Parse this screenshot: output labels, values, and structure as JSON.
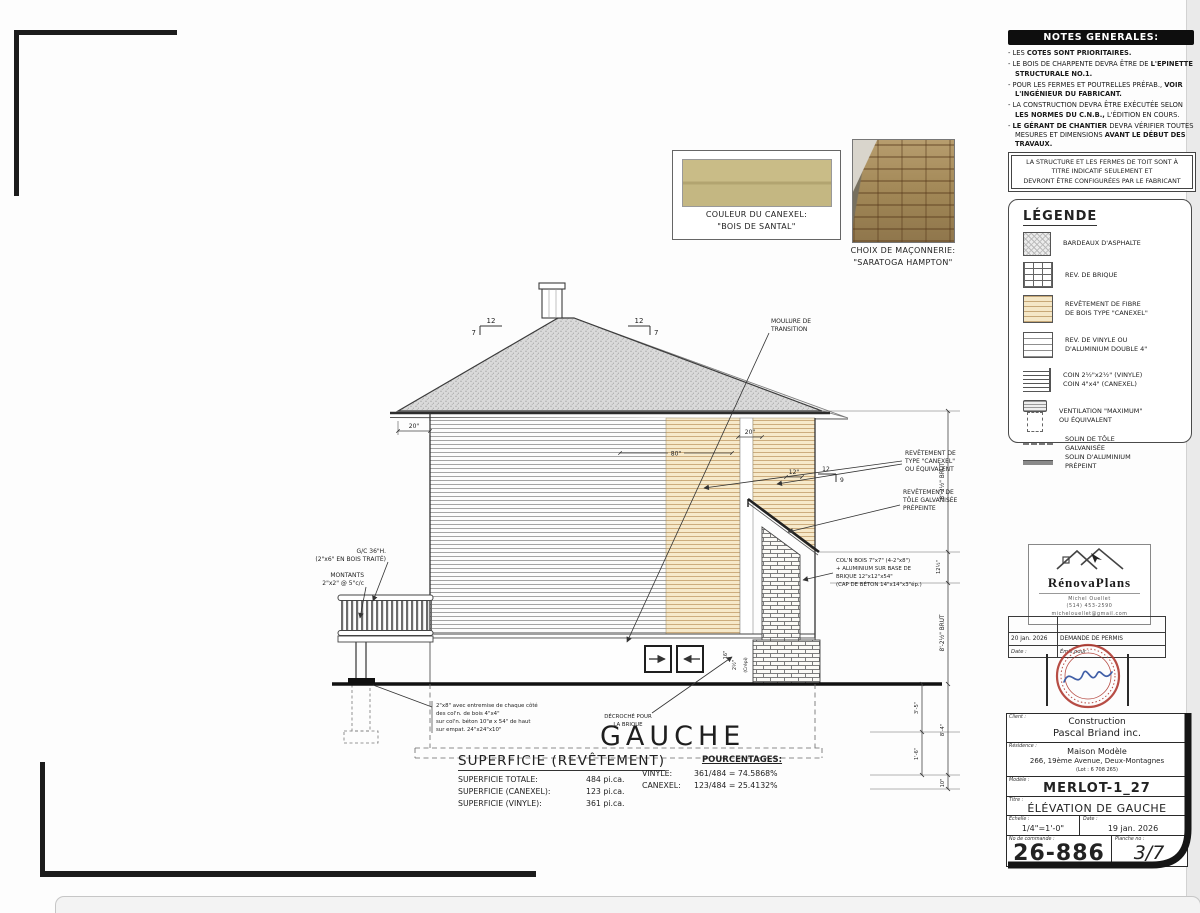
{
  "notes": {
    "header": "NOTES GENERALES:",
    "items": [
      [
        {
          "t": "LES ",
          "b": false
        },
        {
          "t": "COTES SONT PRIORITAIRES.",
          "b": true
        }
      ],
      [
        {
          "t": "LE BOIS DE CHARPENTE DEVRA ÊTRE DE ",
          "b": false
        },
        {
          "t": "L'EPINETTE STRUCTURALE NO.1.",
          "b": true
        }
      ],
      [
        {
          "t": "POUR LES FERMES ET POUTRELLES PRÉFAB., ",
          "b": false
        },
        {
          "t": "VOIR L'INGÉNIEUR DU FABRICANT.",
          "b": true
        }
      ],
      [
        {
          "t": "LA CONSTRUCTION DEVRA ÊTRE EXÉCUTÉE SELON ",
          "b": false
        },
        {
          "t": "LES NORMES DU C.N.B.,",
          "b": true
        },
        {
          "t": " L'ÉDITION EN COURS.",
          "b": false
        }
      ],
      [
        {
          "t": "LE GÉRANT DE CHANTIER ",
          "b": true
        },
        {
          "t": "DEVRA VÉRIFIER TOUTES MESURES ET DIMENSIONS ",
          "b": false
        },
        {
          "t": "AVANT LE DÉBUT DES TRAVAUX.",
          "b": true
        }
      ],
      [
        {
          "t": "AVERTIR",
          "b": true
        },
        {
          "t": " DE TOUTES ERREURS OU OMISSIONS ",
          "b": false
        },
        {
          "t": "AVANT LE DÉBUT DES TRAVAUX.",
          "b": true
        }
      ]
    ],
    "indicative": [
      "LA STRUCTURE ET LES FERMES DE TOIT SONT À",
      "TITRE INDICATIF SEULEMENT ET",
      "DEVRONT ÊTRE CONFIGURÉES PAR LE FABRICANT"
    ]
  },
  "legend": {
    "title": "LÉGENDE",
    "items": [
      {
        "type": "asphalt",
        "lines": [
          "BARDEAUX D'ASPHALTE"
        ]
      },
      {
        "type": "brick",
        "lines": [
          "REV. DE BRIQUE"
        ]
      },
      {
        "type": "canexel",
        "lines": [
          "REVÊTEMENT DE FIBRE",
          "DE BOIS TYPE \"CANEXEL\""
        ]
      },
      {
        "type": "vinyl",
        "lines": [
          "REV. DE VINYLE OU",
          "D'ALUMINIUM DOUBLE 4\""
        ]
      },
      {
        "type": "corner",
        "lines": [
          "COIN 2½\"x2½\" (VINYLE)",
          "COIN 4\"x4\" (CANEXEL)"
        ]
      },
      {
        "type": "vent",
        "lines": [
          "VENTILATION \"MAXIMUM\"",
          "OU ÉQUIVALENT"
        ]
      },
      {
        "type": "dash",
        "lines": [
          "SOLIN DE TÔLE",
          "GALVANISÉE"
        ]
      },
      {
        "type": "solid",
        "lines": [
          "SOLIN D'ALUMINIUM",
          "PRÉPEINT"
        ]
      }
    ]
  },
  "swatches": {
    "canexel_line1": "COULEUR DU CANEXEL:",
    "canexel_line2": "\"BOIS DE SANTAL\"",
    "masonry_line1": "CHOIX DE MAÇONNERIE:",
    "masonry_line2": "\"SARATOGA HAMPTON\""
  },
  "drawing": {
    "title": "GAUCHE",
    "labels": {
      "moulure": [
        "MOULURE DE",
        "TRANSITION"
      ],
      "rev_canexel": [
        "REVÊTEMENT DE",
        "TYPE \"CANEXEL\"",
        "OU ÉQUIVALENT"
      ],
      "rev_tole": [
        "REVÊTEMENT DE",
        "TÔLE GALVANISÉE",
        "PRÉPEINTE"
      ],
      "coln": [
        "COL'N BOIS 7\"x7\" (4-2\"x8\")",
        "+ ALUMINIUM SUR BASE DE",
        "BRIQUE 12\"x12\"x54\"",
        "(CAP DE BÉTON 14\"x14\"x3\"ép.)"
      ],
      "gc": [
        "G/C  36\"H.",
        "(2\"x6\" EN BOIS TRAITÉ)"
      ],
      "montants": [
        "MONTANTS",
        "2\"x2\" @ 5\"c/c"
      ],
      "note2x8": [
        "2\"x8\" avec entremise de chaque côté",
        "des col'n. de bois 4\"x4\"",
        "sur col'n. béton 10\"ø x 54\" de haut",
        "sur empat. 24\"x24\"x10\""
      ],
      "decroche": [
        "DÉCROCHÉ POUR",
        "LA BRIQUE"
      ],
      "crepi": "(Crépi)"
    },
    "dims": {
      "slope_run": "12",
      "slope_rise_main": "7",
      "slope_rise_porch": "9",
      "eave_left": "20\"",
      "eave_right": "20\"",
      "d80": "80\"",
      "d12": "12\"",
      "d16": "16\"",
      "d2h": "2½\"",
      "floor_top": "8'-2½\" BRUT",
      "rim": "12½\"",
      "floor_bottom": "8'-2½\" BRUT",
      "f35": "3'-5\"",
      "f16": "1'-6\"",
      "f84": "8'-4\"",
      "f10": "10\""
    }
  },
  "superficie": {
    "title": "SUPERFICIE (REVÊTEMENT)",
    "rows": [
      [
        "SUPERFICIE TOTALE:",
        "484 pi.ca."
      ],
      [
        "SUPERFICIE (CANEXEL):",
        "123 pi.ca."
      ],
      [
        "SUPERFICIE (VINYLE):",
        "361 pi.ca."
      ]
    ],
    "pct_title": "POURCENTAGES:",
    "pct_rows": [
      [
        "VINYLE:",
        "361/484 = 74.5868%"
      ],
      [
        "CANEXEL:",
        "123/484 = 25.4132%"
      ]
    ]
  },
  "renova": {
    "name": "RénovaPlans",
    "lines": [
      "Michel Ouellet",
      "(514) 453-2590",
      "michelouellet@gmail.com"
    ]
  },
  "permit": {
    "date": "20 jan. 2026",
    "desc": "DEMANDE DE PERMIS",
    "date_label": "Date :",
    "emis_label": "Émis pour :"
  },
  "titleblock": {
    "client_label": "Client :",
    "client1": "Construction",
    "client2": "Pascal Briand inc.",
    "residence_label": "Résidence :",
    "res1": "Maison Modèle",
    "res2": "266, 19ème Avenue, Deux-Montagnes",
    "res3": "(Lot : 6 708 265)",
    "modele_label": "Modèle :",
    "modele": "MERLOT-1_27",
    "titre_label": "Titre :",
    "titre": "ÉLÉVATION DE GAUCHE",
    "echelle_label": "Échelle :",
    "echelle": "1/4\"=1'-0\"",
    "date_label": "Date :",
    "date": "19 jan. 2026",
    "commande_label": "No de commande :",
    "commande": "26-886",
    "planche_label": "Planche no :",
    "planche": "3/7"
  }
}
